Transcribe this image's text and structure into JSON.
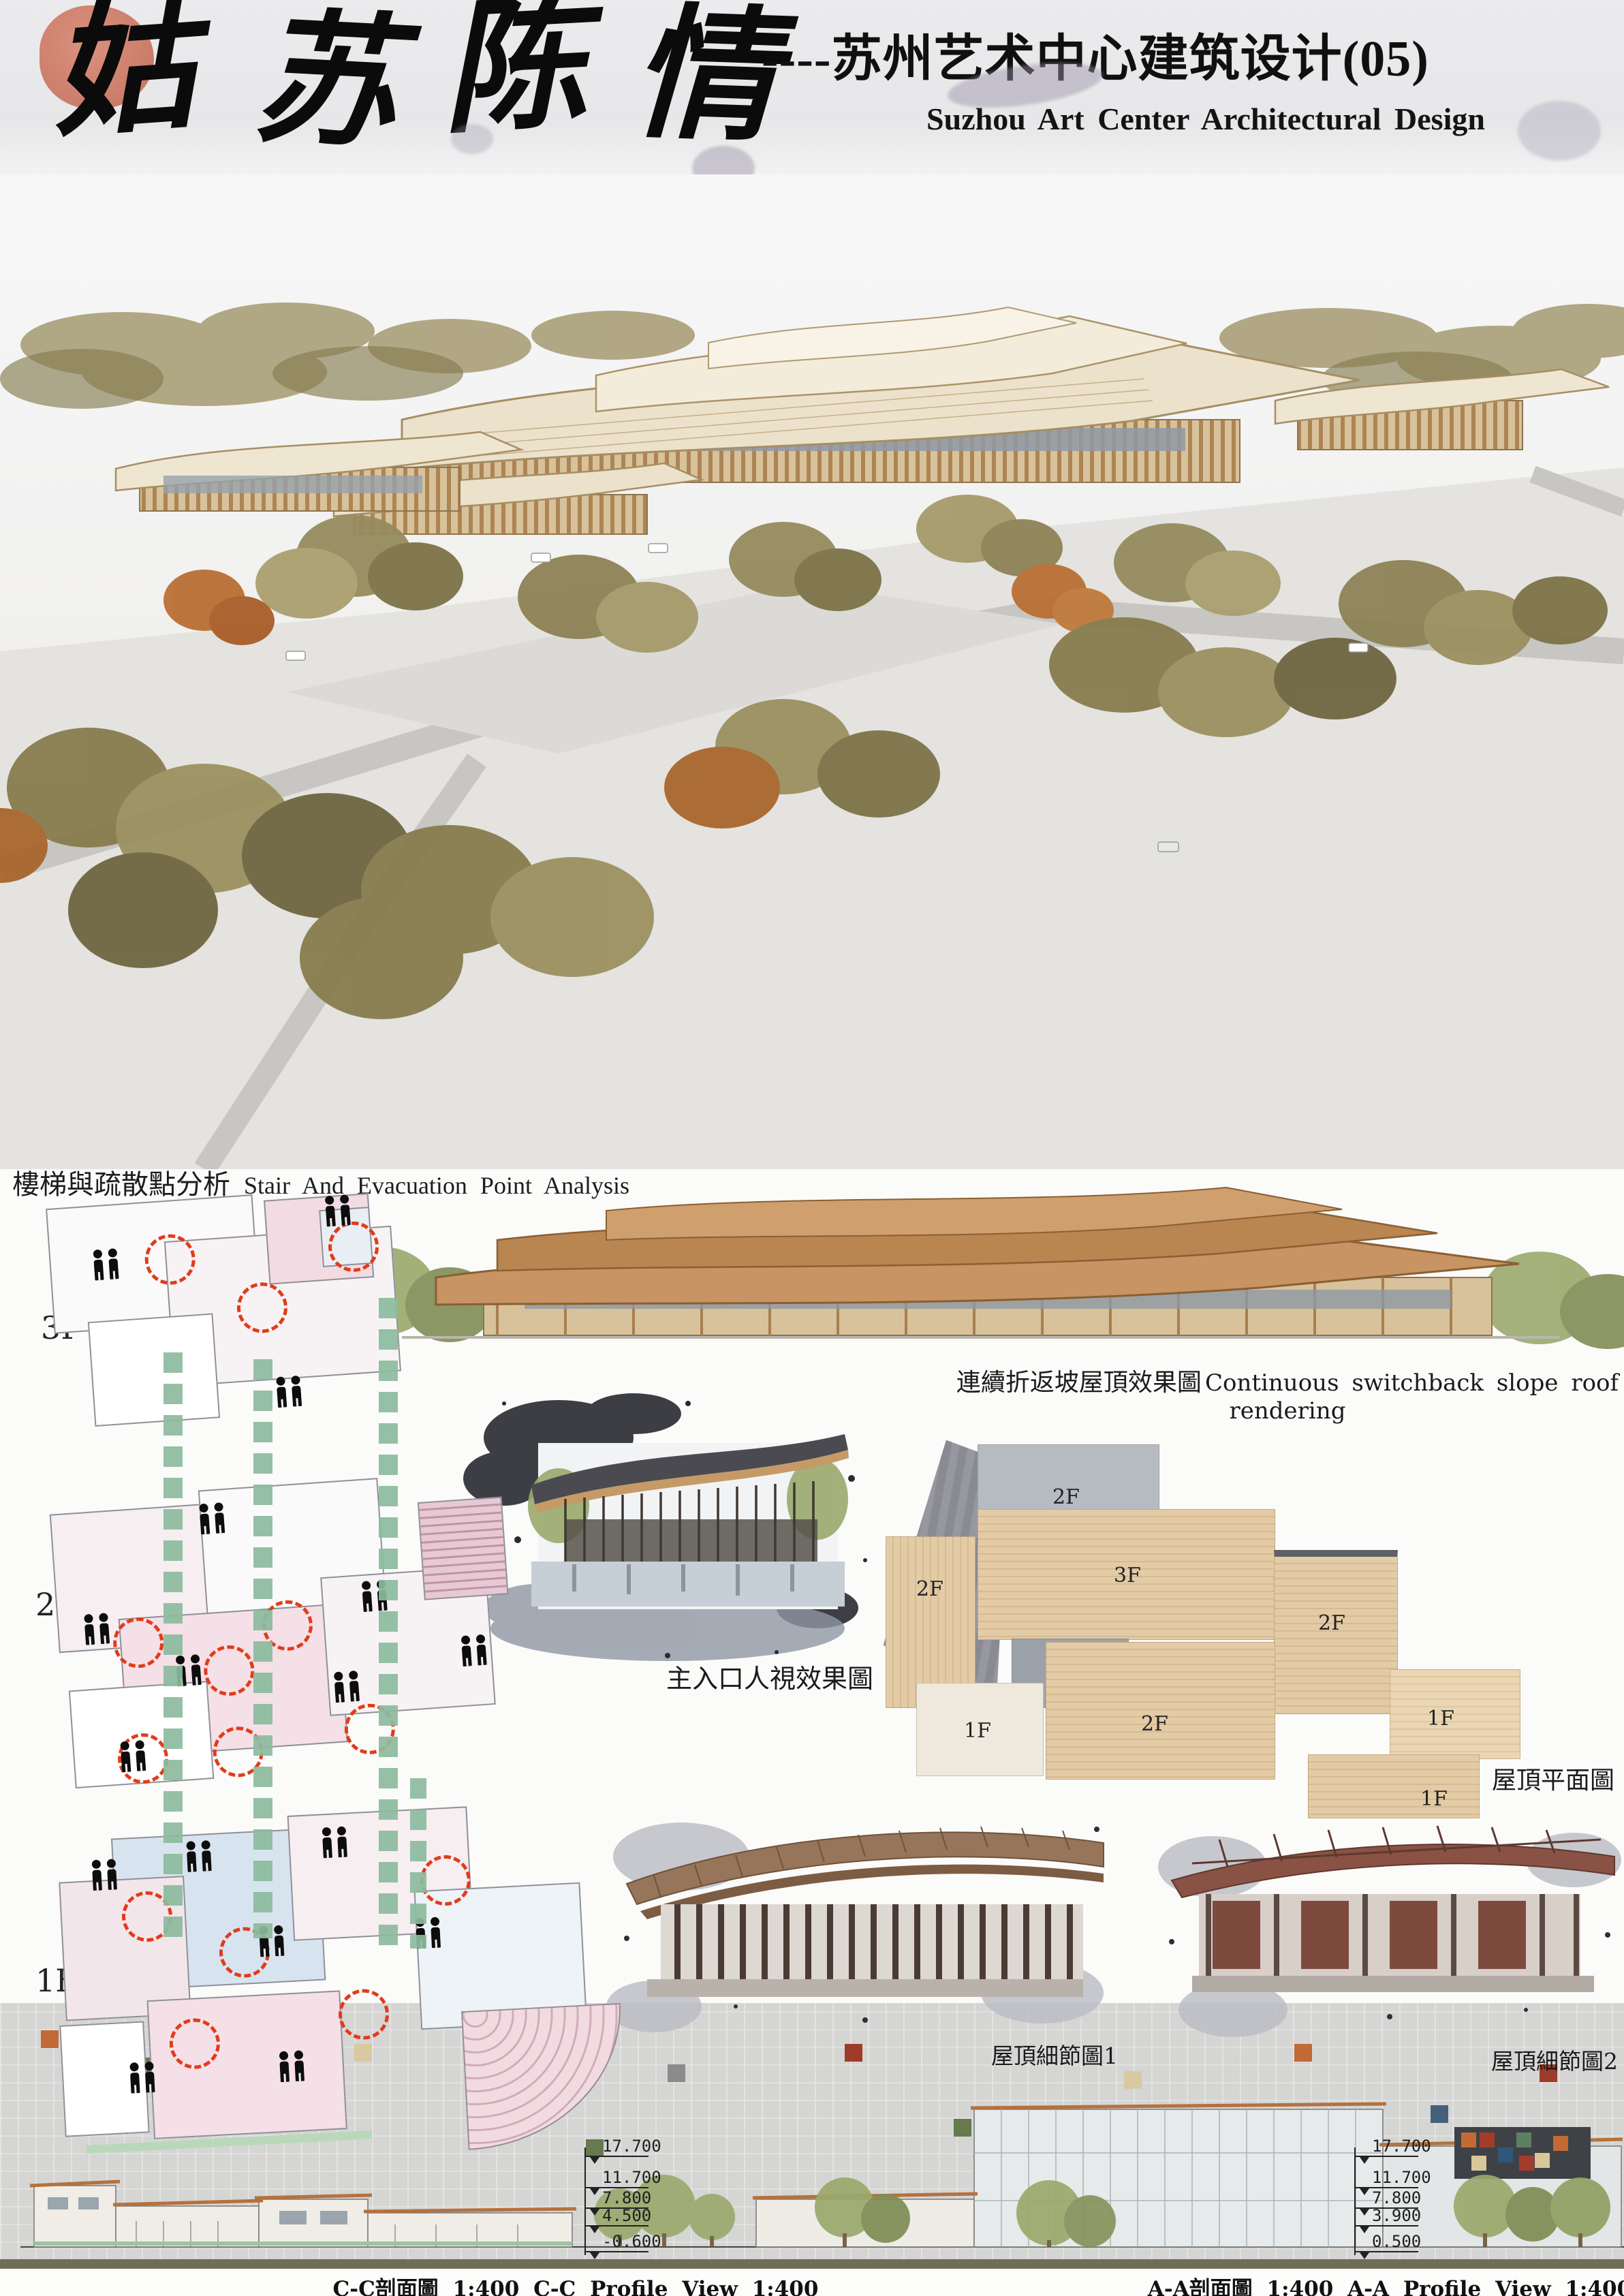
{
  "header": {
    "calligraphy_chars": [
      "姑",
      "苏",
      "陈",
      "情"
    ],
    "title_cn": "----苏州艺术中心建筑设计(05)",
    "title_en": "Suzhou Art Center Architectural Design"
  },
  "analysis": {
    "title_cn": "樓梯與疏散點分析",
    "title_en": "Stair And Evacuation Point Analysis",
    "floors": [
      {
        "label": "3F"
      },
      {
        "label": "2F"
      },
      {
        "label": "1F"
      }
    ]
  },
  "renderings": {
    "switchback_caption_cn": "連續折返坡屋頂效果圖",
    "switchback_caption_en": "Continuous switchback slope roof rendering",
    "entrance_caption": "主入口人視效果圖",
    "roof_detail_1_caption": "屋頂細節圖1",
    "roof_detail_2_caption": "屋頂細節圖2"
  },
  "roof_plan": {
    "caption": "屋頂平面圖",
    "labels": [
      "2F",
      "2F",
      "3F",
      "2F",
      "1F",
      "2F",
      "1F",
      "1F"
    ]
  },
  "sections": {
    "cc": {
      "caption": "C-C剖面圖 1:400 C-C Profile View 1:400",
      "elevations": [
        "17.700",
        "11.700",
        "7.800",
        "4.500",
        "-0.600"
      ]
    },
    "aa": {
      "caption": "A-A剖面圖 1:400 A-A Profile View 1:400",
      "elevations": [
        "17.700",
        "11.700",
        "7.800",
        "3.900",
        "0.500"
      ]
    }
  },
  "colors": {
    "seal_red": "#cb7863",
    "evacuation_red": "#e23b1b",
    "route_green": "#8cbb9e",
    "roof_tan": "#d9bd95",
    "olive_bar": "#6e6e58"
  }
}
